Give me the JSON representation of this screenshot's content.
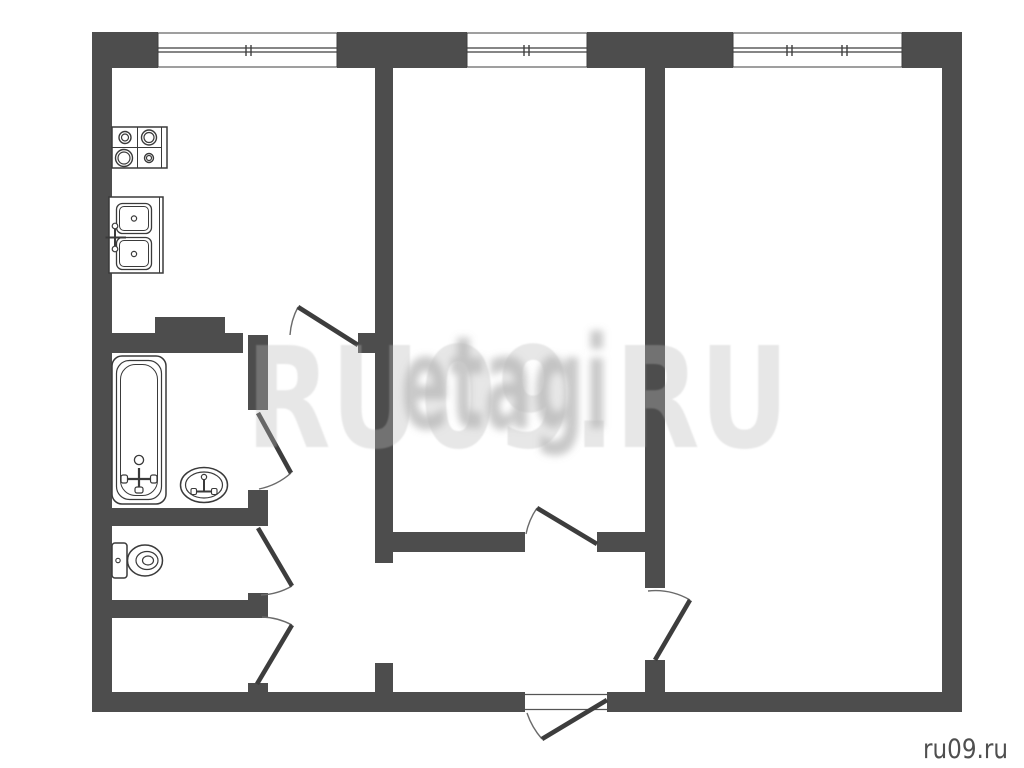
{
  "watermark": {
    "main": "RU09.RU",
    "secondary": "etagi",
    "corner": "ru09.ru"
  },
  "colors": {
    "background": "#ffffff",
    "wall": "#4d4d4d",
    "fixture_stroke": "#3a3a3a",
    "door_leaf": "#3d3d3d",
    "door_arc": "#6a6a6a",
    "window_line": "#3f3f3f",
    "watermark_main": "rgba(185,185,185,0.34)",
    "watermark_secondary": "rgba(125,125,125,0.42)",
    "corner_text": "#4f4f4f"
  },
  "plan": {
    "canvas": {
      "w": 1024,
      "h": 768
    },
    "walls": [
      {
        "name": "outer-left",
        "x": 92,
        "y": 32,
        "w": 20,
        "h": 680
      },
      {
        "name": "outer-top-seg1",
        "x": 92,
        "y": 32,
        "w": 66,
        "h": 36
      },
      {
        "name": "outer-top-seg2",
        "x": 337,
        "y": 32,
        "w": 130,
        "h": 36
      },
      {
        "name": "outer-top-seg3",
        "x": 587,
        "y": 32,
        "w": 146,
        "h": 36
      },
      {
        "name": "outer-top-seg4",
        "x": 902,
        "y": 32,
        "w": 60,
        "h": 36
      },
      {
        "name": "outer-right",
        "x": 942,
        "y": 32,
        "w": 20,
        "h": 680
      },
      {
        "name": "outer-bottom-left",
        "x": 92,
        "y": 692,
        "w": 433,
        "h": 20
      },
      {
        "name": "outer-bottom-right",
        "x": 607,
        "y": 692,
        "w": 355,
        "h": 20
      },
      {
        "name": "kitchen-bottom-left",
        "x": 112,
        "y": 333,
        "w": 131,
        "h": 20
      },
      {
        "name": "kitchen-bottom-right",
        "x": 358,
        "y": 333,
        "w": 35,
        "h": 20
      },
      {
        "name": "kitchen-vent-bump",
        "x": 155,
        "y": 317,
        "w": 70,
        "h": 16
      },
      {
        "name": "bath-corridor-upper",
        "x": 248,
        "y": 335,
        "w": 20,
        "h": 75
      },
      {
        "name": "bath-corridor-jamb1",
        "x": 248,
        "y": 490,
        "w": 20,
        "h": 36
      },
      {
        "name": "bathroom-bottom",
        "x": 112,
        "y": 508,
        "w": 136,
        "h": 18
      },
      {
        "name": "bath-corridor-jamb2",
        "x": 248,
        "y": 593,
        "w": 20,
        "h": 25
      },
      {
        "name": "toilet-bottom",
        "x": 112,
        "y": 600,
        "w": 136,
        "h": 18
      },
      {
        "name": "bath-corridor-jamb3",
        "x": 248,
        "y": 683,
        "w": 20,
        "h": 29
      },
      {
        "name": "middleroom-left",
        "x": 375,
        "y": 68,
        "w": 18,
        "h": 495
      },
      {
        "name": "middleroom-left-stub",
        "x": 375,
        "y": 663,
        "w": 18,
        "h": 29
      },
      {
        "name": "middleroom-bottom-left",
        "x": 393,
        "y": 532,
        "w": 132,
        "h": 20
      },
      {
        "name": "middleroom-bottom-right",
        "x": 597,
        "y": 532,
        "w": 48,
        "h": 20
      },
      {
        "name": "room-divider",
        "x": 645,
        "y": 68,
        "w": 20,
        "h": 520
      },
      {
        "name": "room-divider-stub",
        "x": 645,
        "y": 660,
        "w": 20,
        "h": 32
      }
    ],
    "windows": {
      "y": 33,
      "h": 34,
      "glazing_y": [
        48,
        52
      ],
      "tick_y": [
        45,
        56
      ],
      "items": [
        {
          "name": "kitchen-window",
          "x": 158,
          "w": 179,
          "ticks": [
            246,
            251
          ]
        },
        {
          "name": "middleroom-window",
          "x": 467,
          "w": 120,
          "ticks": [
            524,
            529
          ]
        },
        {
          "name": "rightroom-window",
          "x": 733,
          "w": 169,
          "ticks": [
            787,
            792,
            842,
            847
          ]
        }
      ]
    },
    "doors": [
      {
        "name": "kitchen-door",
        "hinge": [
          358,
          345
        ],
        "tip": [
          298,
          307
        ],
        "wall": [
          290,
          335
        ],
        "sweep": 0
      },
      {
        "name": "bathroom-door",
        "hinge": [
          258,
          413
        ],
        "tip": [
          291,
          473
        ],
        "wall": [
          259,
          489
        ],
        "sweep": 1
      },
      {
        "name": "toilet-door",
        "hinge": [
          258,
          528
        ],
        "tip": [
          292,
          586
        ],
        "wall": [
          261,
          595
        ],
        "sweep": 1
      },
      {
        "name": "storage-door",
        "hinge": [
          257,
          684
        ],
        "tip": [
          292,
          625
        ],
        "wall": [
          262,
          617
        ],
        "sweep": 0
      },
      {
        "name": "middleroom-door",
        "hinge": [
          597,
          544
        ],
        "tip": [
          537,
          508
        ],
        "wall": [
          526,
          534
        ],
        "sweep": 0
      },
      {
        "name": "rightroom-door",
        "hinge": [
          655,
          660
        ],
        "tip": [
          690,
          600
        ],
        "wall": [
          648,
          591
        ],
        "sweep": 0
      },
      {
        "name": "entrance-door",
        "hinge": [
          607,
          700
        ],
        "tip": [
          542,
          739
        ],
        "wall": [
          527,
          713
        ],
        "sweep": 1
      }
    ],
    "entrance_threshold": {
      "x": 525,
      "y": 692,
      "w": 82,
      "h": 20,
      "line_y": [
        694.5,
        709.5
      ]
    },
    "fixtures": {
      "stove": {
        "x": 112,
        "y": 127,
        "w": 55,
        "h": 41,
        "grid_v": 137.5,
        "grid_h": 147.5,
        "edge_v": 161.5,
        "burners": [
          {
            "cx": 125,
            "cy": 137.5,
            "r": 6,
            "r2": 3.5
          },
          {
            "cx": 149,
            "cy": 137.5,
            "r": 7.5,
            "r2": 5
          },
          {
            "cx": 124,
            "cy": 158,
            "r": 8.5,
            "r2": 6
          },
          {
            "cx": 149,
            "cy": 158,
            "r": 4.5,
            "r2": 2.5
          }
        ]
      },
      "kitchen_sink": {
        "x": 109,
        "y": 197,
        "w": 54,
        "h": 76,
        "edge_v": 159.5,
        "bowls": [
          {
            "x": 116.5,
            "y": 203.5,
            "w": 35,
            "h": 30
          },
          {
            "x": 116.5,
            "y": 237.5,
            "w": 35,
            "h": 32
          }
        ],
        "drains": [
          [
            134,
            218.5
          ],
          [
            134,
            254
          ]
        ],
        "faucet": {
          "cx": 115,
          "cy": 237.5,
          "top": 226,
          "bottom": 249,
          "left": 105.5,
          "right": 126
        }
      },
      "bathtub": {
        "x": 112,
        "y": 356,
        "w": 54,
        "h": 148,
        "drain": [
          139,
          460
        ],
        "faucet": {
          "cx": 139,
          "stem_top": 468,
          "stem_bottom": 490,
          "bar_y": 479,
          "bar_l": 124,
          "bar_r": 154
        }
      },
      "bath_sink": {
        "cx": 204,
        "cy": 485,
        "rx": 23.5,
        "ry": 17.5,
        "rx2": 18.5,
        "ry2": 13,
        "faucet": {
          "cx": 204,
          "knob_y": 477,
          "stem_bottom": 492,
          "bar_y": 491.5,
          "bar_l": 194,
          "bar_r": 214
        }
      },
      "toilet": {
        "tank": {
          "x": 112,
          "y": 543,
          "w": 15,
          "h": 35
        },
        "button": [
          118,
          560.5
        ],
        "bowl": [
          {
            "cx": 145,
            "cy": 560.5,
            "rx": 17.5,
            "ry": 15.5
          },
          {
            "cx": 147,
            "cy": 560.5,
            "rx": 11,
            "ry": 9
          },
          {
            "cx": 148,
            "cy": 560.5,
            "rx": 5.5,
            "ry": 4.5
          }
        ]
      }
    }
  }
}
